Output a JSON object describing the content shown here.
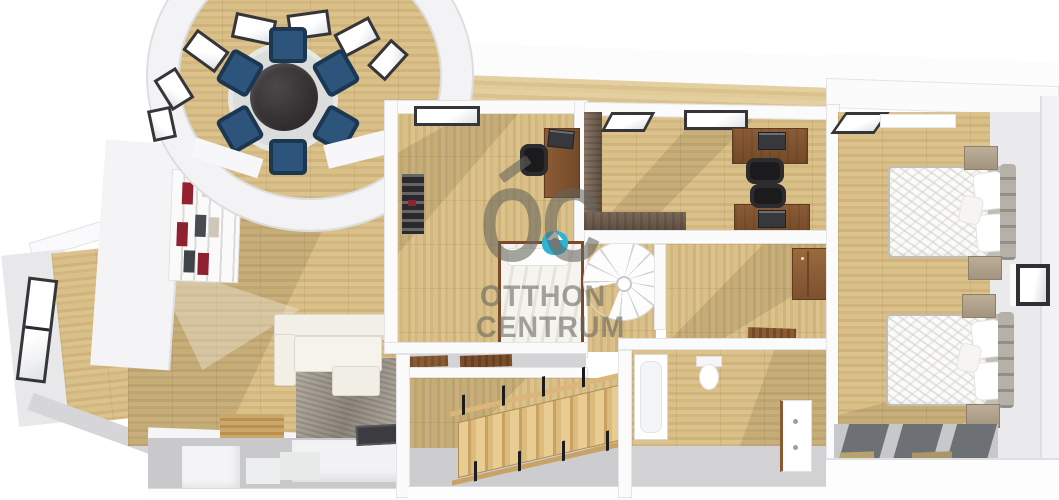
{
  "watermark": {
    "logo": "OC",
    "line1": "OTTHON",
    "line2": "CENTRUM",
    "text_color": "#64645c",
    "icon_color": "#2cb4d7"
  },
  "palette": {
    "background": "#ffffff",
    "wood_floor": "#d8be88",
    "wood_floor_dark": "#cfb37a",
    "wall_white": "#fbfbfc",
    "wall_gray": "#d8d8db",
    "dining_chair_navy": "#2d547a",
    "dining_table_black": "#373233",
    "shelf_book_red": "#8e2230",
    "desk_brown": "#7d5130",
    "knee_wall_brown": "#6e5c4c",
    "stair_wood": "#d9b87f",
    "teal_accent": "#2cb4d7",
    "living_rug_gray": "#8f8b84",
    "bedroom_rug_stripe": "#6d7175"
  },
  "scene": {
    "description": "3D top-down floor plan rendering of an attic level",
    "rooms": [
      "turret dining room",
      "living room",
      "kitchen on lower level",
      "office with single bed",
      "office with two desks",
      "spiral staircase landing",
      "hallway",
      "stairwell",
      "bathroom",
      "bedroom with two double beds"
    ]
  }
}
